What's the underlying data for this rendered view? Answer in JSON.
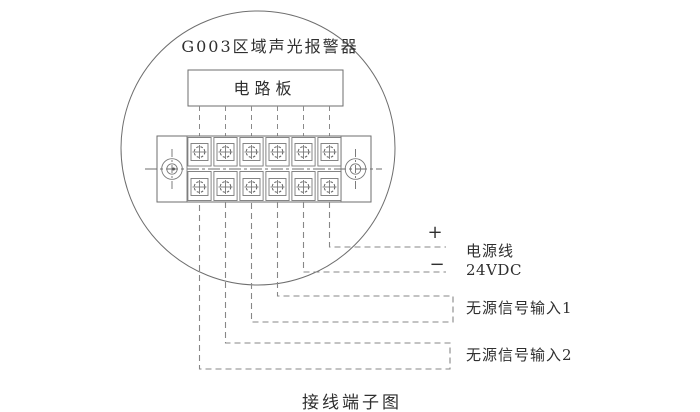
{
  "diagram": {
    "device_label": "G003区域声光报警器",
    "board_label": "电路板",
    "caption": "接线端子图",
    "terminal_block": {
      "rows": 2,
      "columns": 6
    },
    "labels": {
      "plus": "+",
      "minus": "−",
      "power_line": "电源线",
      "power_voltage": "24VDC",
      "signal_input_1": "无源信号输入1",
      "signal_input_2": "无源信号输入2"
    },
    "colors": {
      "background": "#ffffff",
      "line": "#6e6e6e",
      "dashed_wire": "#878787",
      "text": "#2f2f2f"
    }
  }
}
